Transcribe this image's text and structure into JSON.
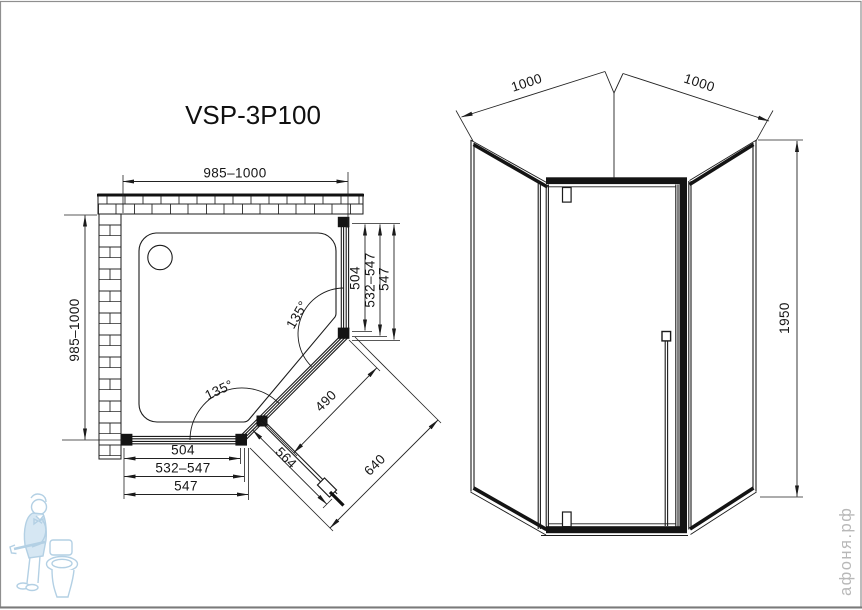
{
  "title": "VSP-3P100",
  "plan_view": {
    "dims": {
      "top_width": "985–1000",
      "left_depth": "985–1000",
      "right_glass": "504",
      "right_adjust": "532–547",
      "right_total": "547",
      "bottom_glass": "504",
      "bottom_adjust": "532–547",
      "bottom_total": "547",
      "angle_top": "135°",
      "angle_bottom": "135°",
      "door_glass": "490",
      "door_open": "564",
      "diagonal_opening": "640"
    }
  },
  "front_view": {
    "dims": {
      "left_wall_width": "1000",
      "right_wall_width": "1000",
      "height": "1950"
    }
  },
  "watermark": {
    "site_text": "афоня.рф",
    "text_color": "#b8b8b8",
    "mascot": "plumber-with-wrench-and-toilet",
    "mascot_color": "#a6c8e0"
  },
  "colors": {
    "line": "#1b1b1b",
    "border": "#8f8f8f",
    "background": "#ffffff"
  }
}
